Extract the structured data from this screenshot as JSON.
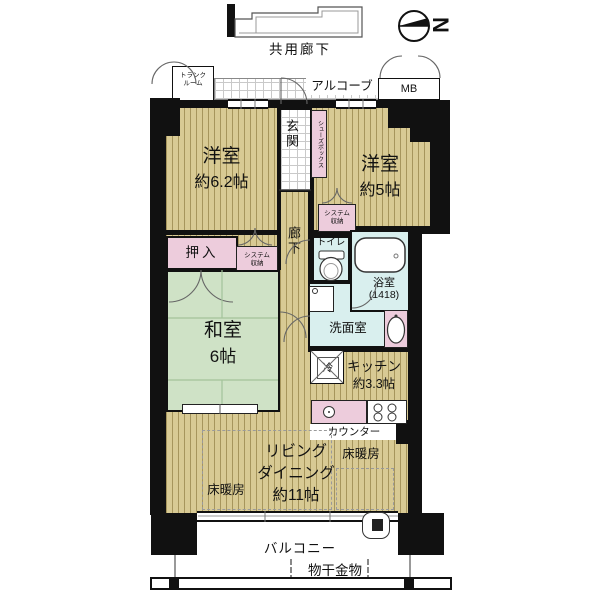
{
  "colors": {
    "wall": "#111111",
    "wood": "#d8ca94",
    "tatami": "#cfe2c6",
    "closet": "#edccdc",
    "wet": "#d9efee"
  },
  "header": {
    "shared_corridor": "共用廊下",
    "compass_letter": "N"
  },
  "corridor": {
    "trunk_line1": "トランク",
    "trunk_line2": "ルーム",
    "alcove": "アルコーブ",
    "meter_box": "MB"
  },
  "rooms": {
    "entrance": "玄関",
    "shoe_box": "シューズボックス",
    "hallway": "廊下",
    "bedroom_west_name": "洋室",
    "bedroom_west_size": "約6.2帖",
    "bedroom_east_name": "洋室",
    "bedroom_east_size": "約5帖",
    "system_storage_line1": "システム",
    "system_storage_line2": "収納",
    "oshiire": "押入",
    "toilet": "トイレ",
    "bath_name": "浴室",
    "bath_size": "(1418)",
    "washroom": "洗面室",
    "washitsu_name": "和室",
    "washitsu_size": "6帖",
    "refrigerator": "冷",
    "kitchen_name": "キッチン",
    "kitchen_size": "約3.3帖",
    "counter": "カウンター",
    "living_line1": "リビング",
    "living_line2": "ダイニング",
    "living_line3": "約11帖",
    "floor_heating": "床暖房"
  },
  "balcony": {
    "label": "バルコニー",
    "laundry_hardware": "物干金物"
  }
}
